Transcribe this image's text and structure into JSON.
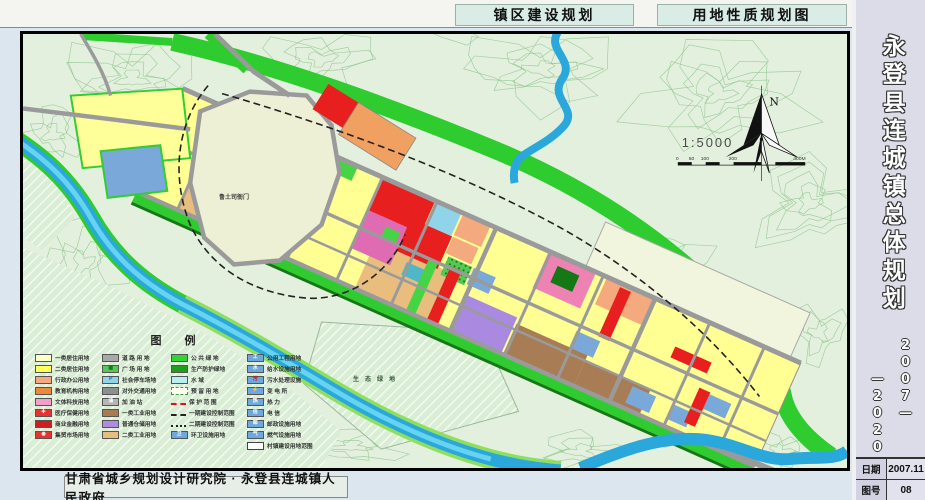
{
  "header": {
    "title_left": "镇区建设规划",
    "title_right": "用地性质规划图"
  },
  "sidebar": {
    "title": "永登县连城镇总体规划",
    "year_top": "2007—",
    "year_bottom": "—2020",
    "fields": [
      {
        "label": "日期",
        "value": "2007.11"
      },
      {
        "label": "图号",
        "value": "08"
      }
    ]
  },
  "footer": {
    "agency": "甘肃省城乡规划设计研究院 · 永登县连城镇人民政府"
  },
  "map": {
    "north_label": "N",
    "scale_text": "1:5000",
    "scale_ticks": [
      "0",
      "50",
      "100",
      "200",
      "400M"
    ],
    "labels": {
      "yamen": "鲁土司衙门",
      "eco": "生态绿地"
    },
    "legend": {
      "title": "图    例",
      "columns": [
        [
          {
            "label": "一类居住用地",
            "color": "#ffffc8"
          },
          {
            "label": "二类居住用地",
            "color": "#ffff5e"
          },
          {
            "label": "行政办公用地",
            "color": "#f5a97e"
          },
          {
            "label": "教育机构用地",
            "color": "#f0883c"
          },
          {
            "label": "文体科技用地",
            "color": "#f2a0c8"
          },
          {
            "label": "医疗保健用地",
            "color": "#e63232",
            "sym": "✚",
            "symColor": "#fff"
          },
          {
            "label": "商业金融用地",
            "color": "#cc1f1f"
          },
          {
            "label": "集贸市场用地",
            "color": "#e63232",
            "sym": "◉",
            "symColor": "#fff"
          }
        ],
        [
          {
            "label": "道 路 用 地",
            "color": "#a8a8a8"
          },
          {
            "label": "广 场 用 地",
            "color": "#55c855",
            "sym": "▦",
            "symColor": "#1d6e1d"
          },
          {
            "label": "社会停车场地",
            "color": "#8fd4e8",
            "sym": "P",
            "symColor": "#1a56a8"
          },
          {
            "label": "对外交通用地",
            "color": "#8f8f8f"
          },
          {
            "label": "加 油 站",
            "color": "#b5b5b5",
            "sym": "油",
            "symColor": "#fff"
          },
          {
            "label": "一类工业用地",
            "color": "#a87c50"
          },
          {
            "label": "普通仓储用地",
            "color": "#b08ce0"
          },
          {
            "label": "二类工业用地",
            "color": "#e9bd7d"
          }
        ],
        [
          {
            "label": "公 共 绿 地",
            "color": "#33d433"
          },
          {
            "label": "生产防护绿地",
            "color": "#1e9e1e"
          },
          {
            "label": "水    域",
            "color": "#b8eef2"
          },
          {
            "label": "预 留 用 地",
            "style": "dashedbox"
          },
          {
            "label": "保 护 范 围",
            "style": "redline"
          },
          {
            "label": "一期建设控制范围",
            "style": "dashdot"
          },
          {
            "label": "二期建设控制范围",
            "style": "ticksline"
          },
          {
            "label": "环卫设施用地",
            "color": "#6fa8dc",
            "sym": "卫",
            "symColor": "#fff"
          }
        ],
        [
          {
            "label": "公用工程用地",
            "color": "#6fa8dc",
            "sym": "工",
            "symColor": "#fff"
          },
          {
            "label": "给水设施用地",
            "color": "#6fa8dc",
            "sym": "水",
            "symColor": "#fff"
          },
          {
            "label": "污水处理设施",
            "color": "#6fa8dc",
            "sym": "污",
            "symColor": "#d01010"
          },
          {
            "label": "变 电 所",
            "color": "#6fa8dc",
            "sym": "⚡",
            "symColor": "#d01010"
          },
          {
            "label": "热    力",
            "color": "#6fa8dc",
            "sym": "热",
            "symColor": "#fff"
          },
          {
            "label": "电    信",
            "color": "#6fa8dc",
            "sym": "信",
            "symColor": "#fff"
          },
          {
            "label": "邮政设施用地",
            "color": "#6fa8dc",
            "sym": "邮",
            "symColor": "#fff"
          },
          {
            "label": "燃气设施用地",
            "color": "#6fa8dc",
            "sym": "气",
            "symColor": "#fff"
          },
          {
            "label": "村镇建设用地范围",
            "style": "outline"
          }
        ]
      ]
    }
  },
  "colors": {
    "residential_yellow": "#ffff94",
    "commercial_red": "#e81f1f",
    "green_public": "#2ecc2e",
    "green_protect": "#157815",
    "water": "#2aa8dc",
    "road_gray": "#9a9a9a",
    "historic_mauve": "#c585b5",
    "industry_brown": "#a87c55",
    "storage_purple": "#a98ae0",
    "utility_blue": "#7aa8d8"
  }
}
